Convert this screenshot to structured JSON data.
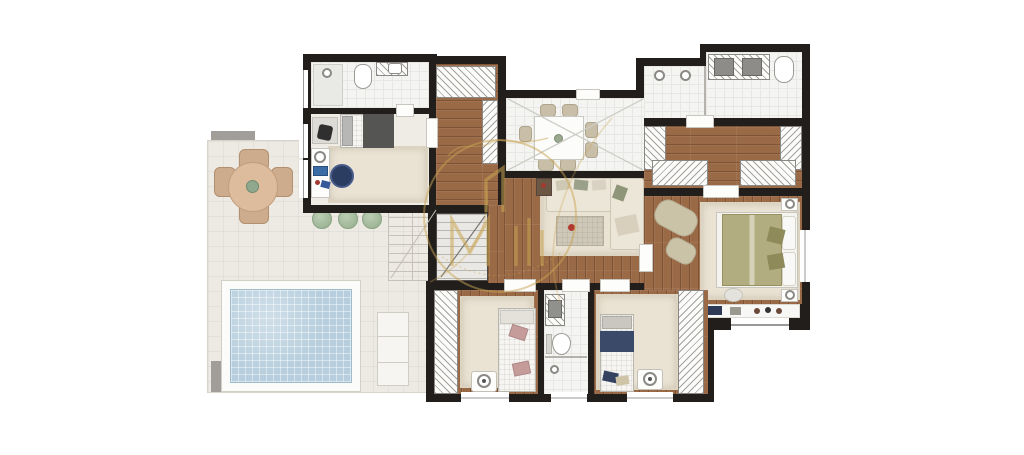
{
  "title": "Apartment floor plan with terrace and swimming pool",
  "watermark": {
    "name": "developer-logo-watermark",
    "style": "semi-transparent gold circle containing a monogram with a house gable glyph, script flourish above and small script along the lower arc",
    "color": "#c9a452"
  },
  "palette": {
    "wall": "#211e1c",
    "wood_floor": "#9a6946",
    "white_floor": "#f4f4f2",
    "terrace_floor": "#edeae3",
    "pool_water": "#b6cedd",
    "rug_cream": "#eae3d4",
    "accent_gold": "#c9a452",
    "accent_navy": "#3c4a6a",
    "accent_olive": "#b2ad80",
    "accent_pink": "#c59c9a",
    "greenery": "#a9bfa2"
  },
  "rooms": [
    {
      "id": "terrace",
      "label": "Terrace / deck",
      "features": [
        "round table with 4 chairs",
        "3 shrubs",
        "outdoor staircase",
        "swimming pool",
        "sun lounger",
        "planters"
      ]
    },
    {
      "id": "bathroom-top-left",
      "label": "Bathroom (top left)",
      "features": [
        "shower",
        "toilet",
        "vanity with sink"
      ]
    },
    {
      "id": "bedroom-top-left",
      "label": "Bedroom (top left)",
      "features": [
        "single bed",
        "desk with chair",
        "media console",
        "round navy rug",
        "cream rug"
      ]
    },
    {
      "id": "hall-closets",
      "label": "Hall with closets",
      "features": [
        "wardrobe hatch",
        "closet strip"
      ]
    },
    {
      "id": "staircase",
      "label": "Internal staircase",
      "features": [
        "steps",
        "cut line"
      ]
    },
    {
      "id": "dining-room",
      "label": "Dining room over double-height void",
      "features": [
        "white table",
        "7 chairs",
        "X void marking"
      ]
    },
    {
      "id": "living-room",
      "label": "Living room",
      "features": [
        "L-shaped sofa with pillows",
        "coffee table",
        "side table",
        "cream rug"
      ]
    },
    {
      "id": "master-bathroom",
      "label": "Master bathroom",
      "features": [
        "double shower",
        "double vanity",
        "toilet"
      ]
    },
    {
      "id": "walk-in-closet",
      "label": "Walk-in closet",
      "features": [
        "wardrobes on three sides"
      ]
    },
    {
      "id": "master-bedroom",
      "label": "Master suite",
      "features": [
        "double bed with olive duvet",
        "two nightstands",
        "chaise with ottoman",
        "pouf",
        "TV console",
        "window"
      ]
    },
    {
      "id": "bedroom-bottom-left",
      "label": "Bedroom (bottom left)",
      "features": [
        "bed with pink pillows",
        "wardrobe",
        "rug",
        "fan unit",
        "window"
      ]
    },
    {
      "id": "bathroom-bottom",
      "label": "Bathroom (bottom)",
      "features": [
        "vanity",
        "toilet",
        "shower with drain",
        "window"
      ]
    },
    {
      "id": "bedroom-bottom-right",
      "label": "Bedroom (bottom right)",
      "features": [
        "bed with navy runner",
        "wardrobe",
        "rug",
        "fan unit",
        "window"
      ]
    }
  ]
}
